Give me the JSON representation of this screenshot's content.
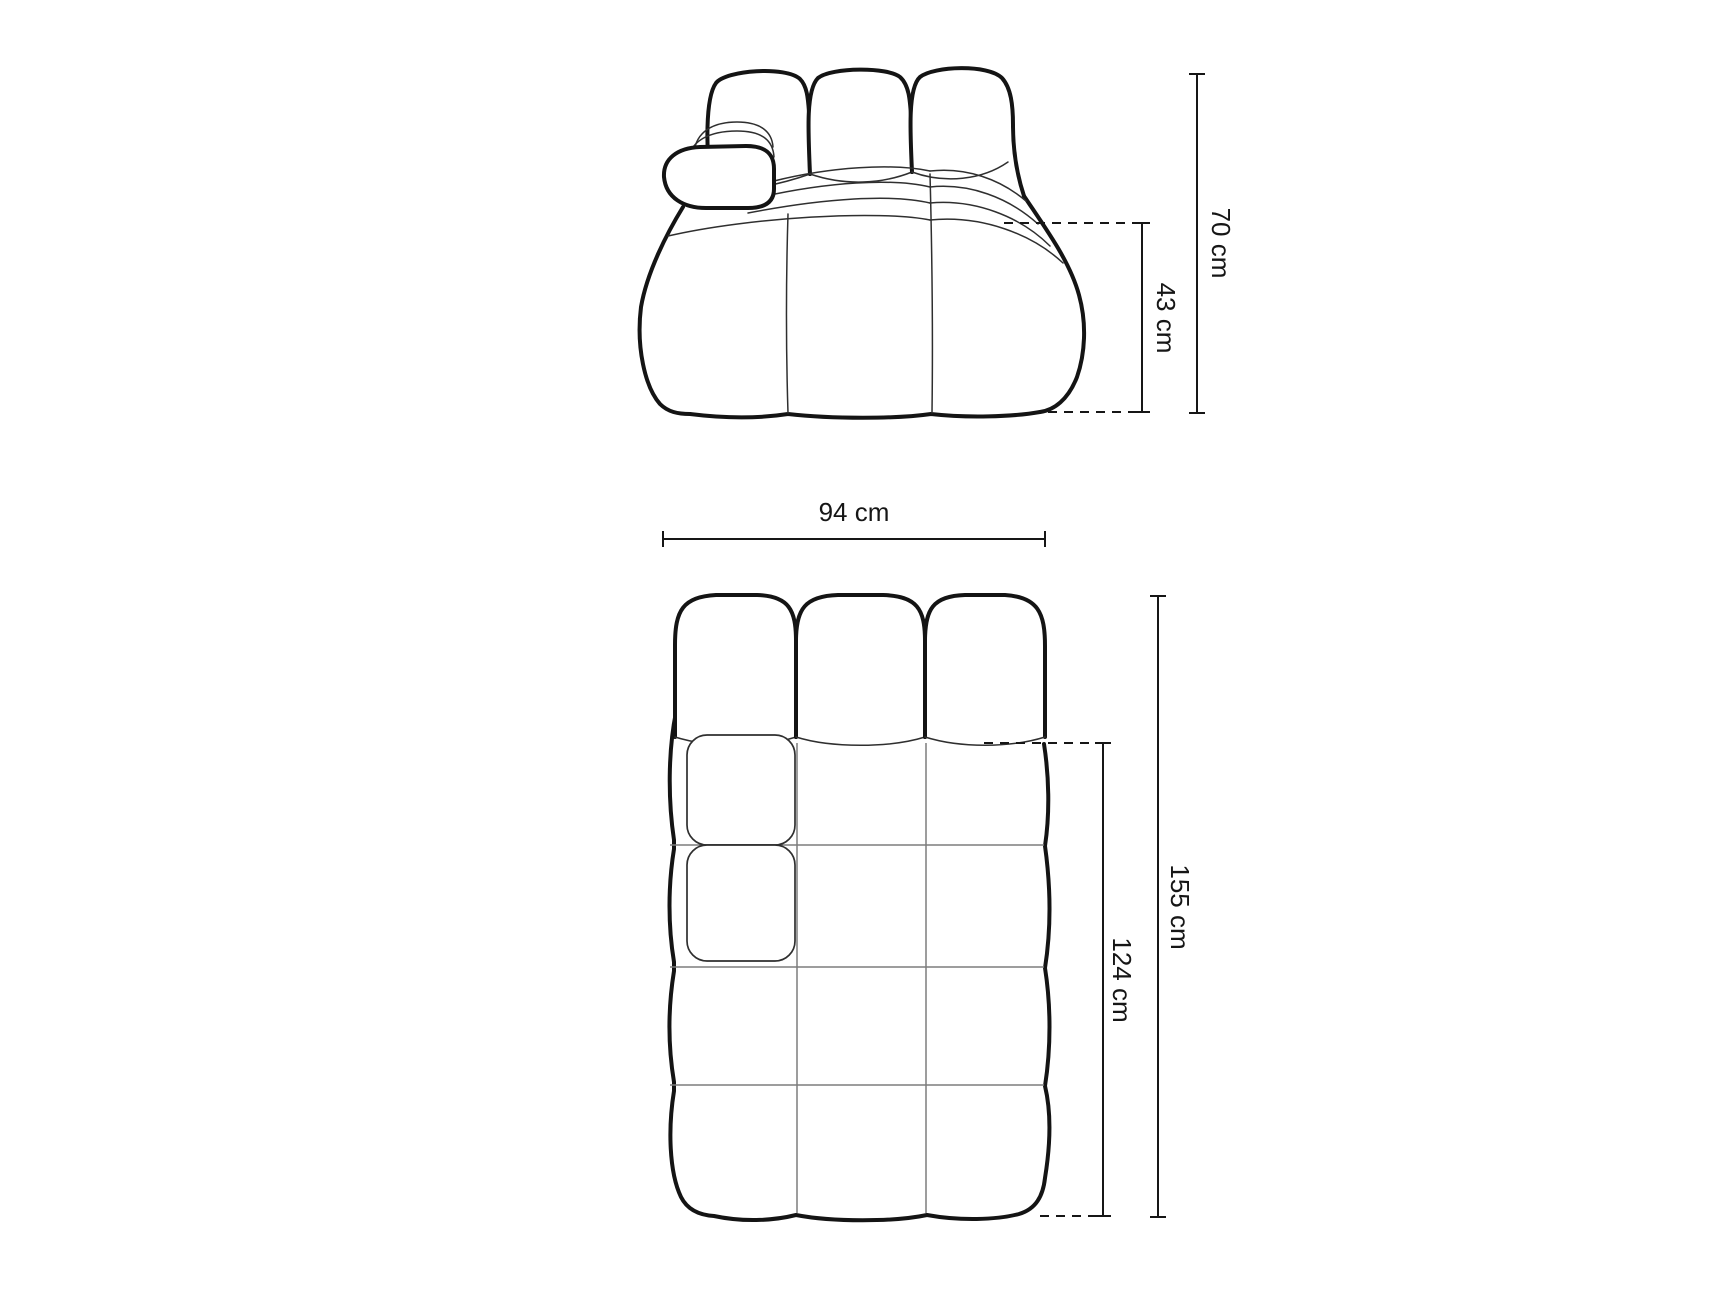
{
  "diagram": {
    "kind": "furniture-dimension-drawing",
    "subject": "tufted modular sofa element with left armrest",
    "front_view": {
      "name": "front-elevation",
      "overall_height": {
        "label": "70 cm",
        "value": 70,
        "unit": "cm"
      },
      "seat_height": {
        "label": "43 cm",
        "value": 43,
        "unit": "cm"
      }
    },
    "top_view": {
      "name": "plan-view",
      "width": {
        "label": "94 cm",
        "value": 94,
        "unit": "cm"
      },
      "overall_depth": {
        "label": "155 cm",
        "value": 155,
        "unit": "cm"
      },
      "seat_depth": {
        "label": "124 cm",
        "value": 124,
        "unit": "cm"
      }
    },
    "colors": {
      "background": "#ffffff",
      "outline": "#141414",
      "inner_line": "#2f2f2f",
      "grid_line": "#7d7d7d",
      "dimension_line": "#161616"
    }
  }
}
